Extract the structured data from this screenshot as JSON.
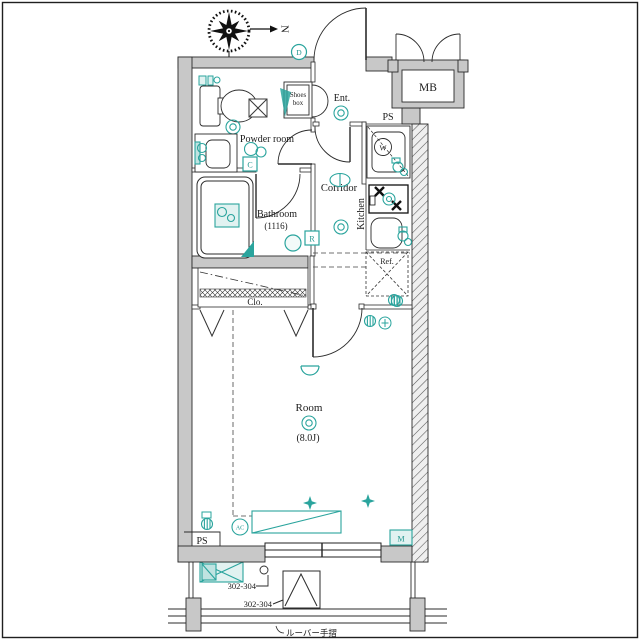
{
  "labels": {
    "compass_north": "N",
    "entrance": "Ent.",
    "shoes_box_line1": "Shoes",
    "shoes_box_line2": "box",
    "meter_box": "MB",
    "pipe_shaft_top": "PS",
    "powder_room": "Powder room",
    "bathroom": "Bathroom",
    "bathroom_size": "(1116)",
    "corridor": "Corridor",
    "kitchen": "Kitchen",
    "refrigerator": "Ref.",
    "closet": "Clo.",
    "main_room": "Room",
    "main_room_size": "(8.0J)",
    "pipe_shaft_bottom": "PS",
    "tag_d": "D",
    "tag_c": "C",
    "tag_r": "R",
    "tag_w": "W",
    "tag_ac": "AC",
    "tag_m": "M",
    "balcony_hatch_units": "302-304",
    "balcony_partition_units": "302-304",
    "railing_note": "ルーバー手摺"
  },
  "colors": {
    "wall_fill": "#c8c8c8",
    "line": "#2b2b2b",
    "fixture_teal": "#2aa49d",
    "fixture_teal_light": "#e1f2f1"
  }
}
